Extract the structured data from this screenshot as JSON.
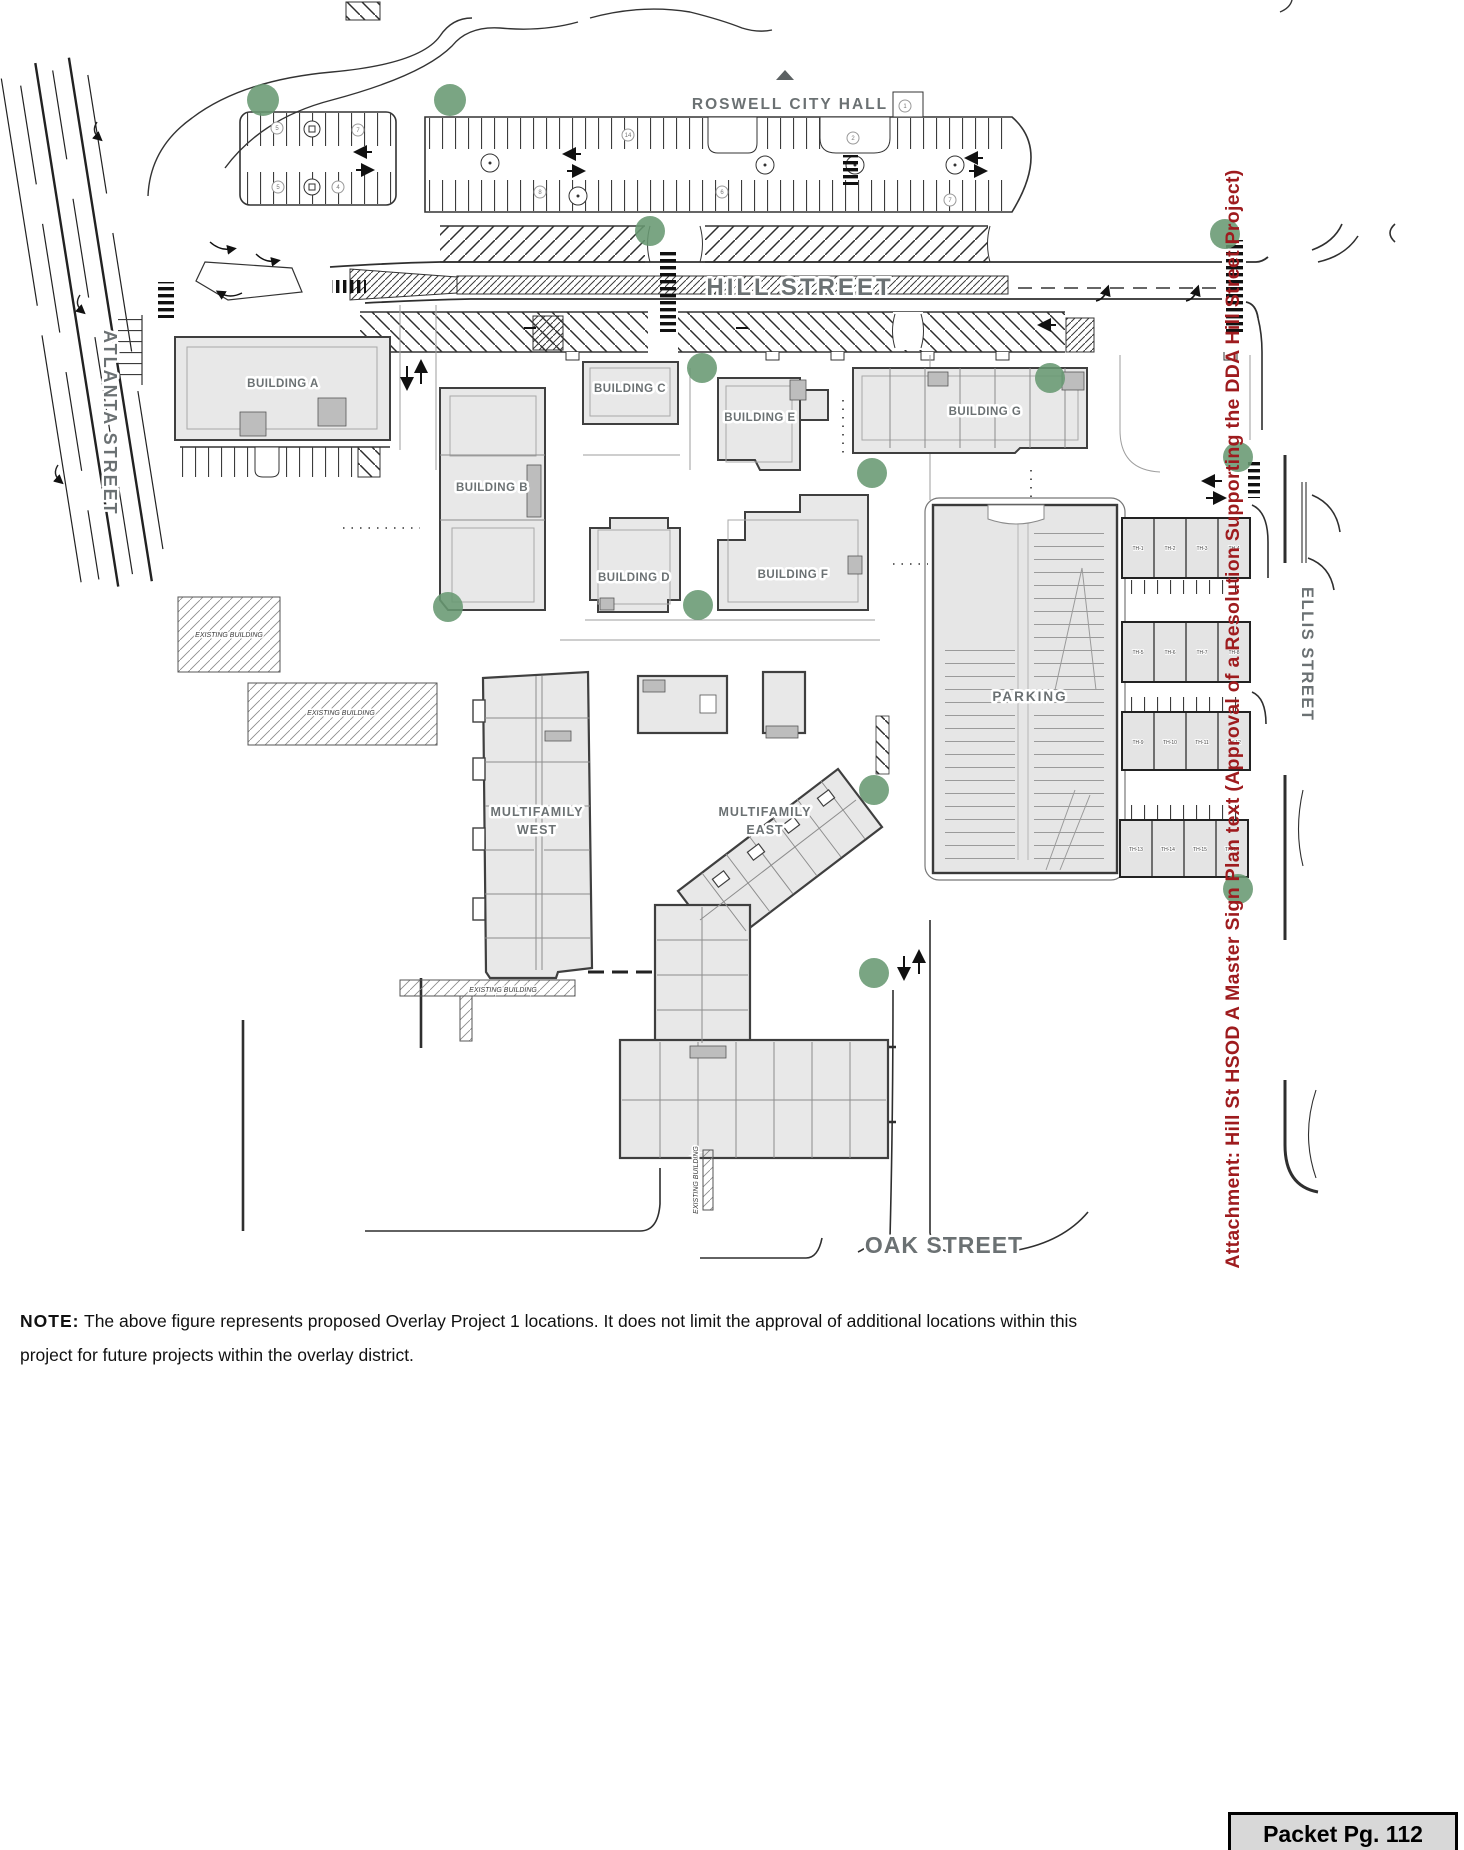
{
  "page": {
    "note": {
      "label": "NOTE:",
      "line1": "The above figure represents proposed Overlay Project 1 locations. It does not limit the approval of additional locations within this",
      "line2": "project for future projects within the overlay district."
    },
    "sidebar": {
      "text": "Attachment: Hill St HSOD A Master Sign Plan text  (Approval of a Resolution Supporting the DDA Hill Street Project)",
      "color": "#9e1b1e"
    },
    "packet_badge": {
      "text": "Packet Pg. 112"
    }
  },
  "plan": {
    "city_hall_label": "ROSWELL CITY HALL",
    "streets": {
      "hill": "HILL STREET",
      "atlanta": "ATLANTA STREET",
      "ellis": "ELLIS STREET",
      "oak": "OAK STREET"
    },
    "buildings": {
      "a": "BUILDING A",
      "b": "BUILDING B",
      "c": "BUILDING C",
      "d": "BUILDING D",
      "e": "BUILDING E",
      "f": "BUILDING F",
      "g": "BUILDING G"
    },
    "multifamily_west": {
      "line1": "MULTIFAMILY",
      "line2": "WEST"
    },
    "multifamily_east": {
      "line1": "MULTIFAMILY",
      "line2": "EAST"
    },
    "parking_label": "PARKING",
    "existing_building_label": "EXISTING BUILDING",
    "townhomes": [
      "TH-1",
      "TH-2",
      "TH-3",
      "TH-4",
      "TH-5",
      "TH-6",
      "TH-7",
      "TH-8",
      "TH-9",
      "TH-10",
      "TH-11",
      "TH-12",
      "TH-13",
      "TH-14",
      "TH-15",
      "TH-16"
    ],
    "stall_numbers": [
      "5",
      "7",
      "5",
      "4",
      "14",
      "2",
      "1",
      "6",
      "8",
      "7"
    ],
    "marker_color": "#689972"
  }
}
